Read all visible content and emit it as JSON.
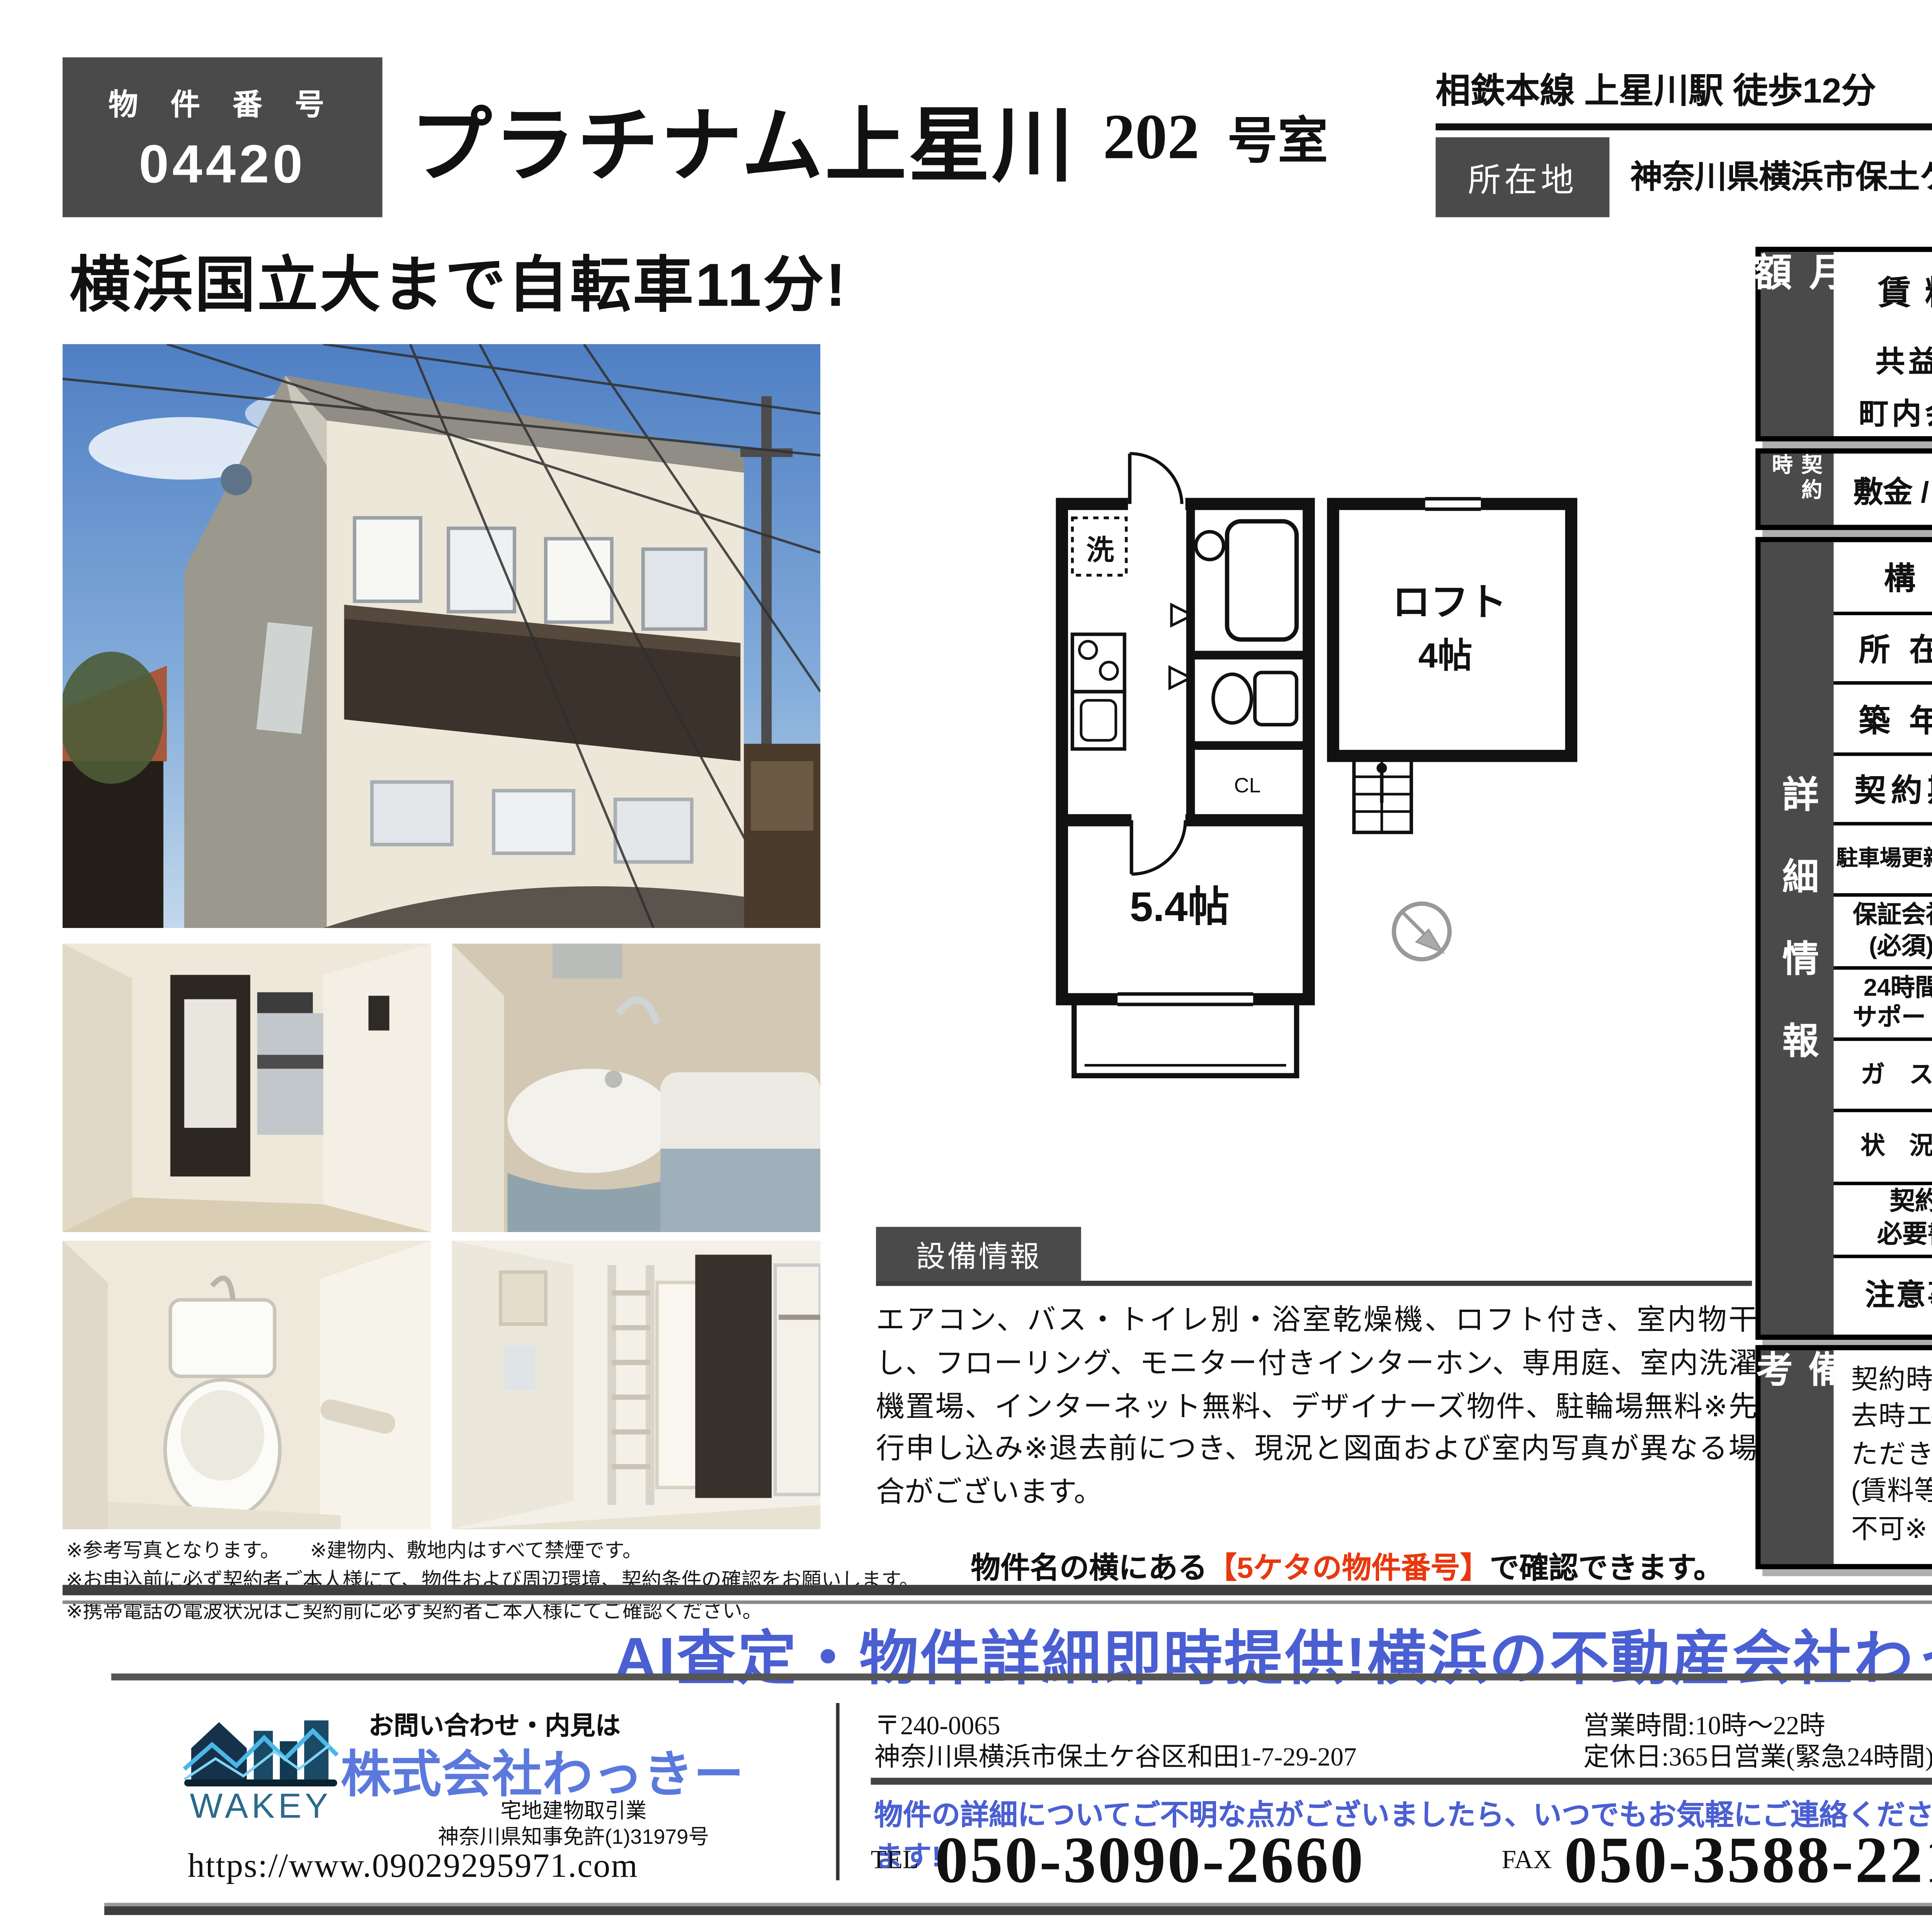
{
  "colors": {
    "accent_blue": "#4a5fd2",
    "brand_blue": "#5b79dd",
    "highlight_red": "#e8380f",
    "dark_gray": "#4a4a4a",
    "consult_bg": "#cfe3ea"
  },
  "header": {
    "property_number_label": "物 件 番 号",
    "property_number": "04420",
    "title": "プラチナム上星川",
    "room_number": "202",
    "room_suffix": "号室",
    "station": "相鉄本線 上星川駅 徒歩12分",
    "location_label": "所在地",
    "address": "神奈川県横浜市保土ケ谷区坂本町326-17",
    "layout": "1K",
    "area_label": "専有面積",
    "area_value": "16.66㎡"
  },
  "catchphrase": "横浜国立大まで自転車11分!",
  "photo_notes": [
    "※参考写真となります。　　※建物内、敷地内はすべて禁煙です。",
    "※お申込前に必ず契約者ご本人様にて、物件および周辺環境、契約条件の確認をお願いします。",
    "※携帯電話の電波状況はご契約前に必ず契約者ご本人様にてご確認ください。"
  ],
  "floorplan": {
    "laundry": "洗",
    "closet": "CL",
    "room_size": "5.4帖",
    "loft_label": "ロフト",
    "loft_size": "4帖"
  },
  "rent_table": {
    "sidebar": "月額",
    "rent_label": "賃料",
    "rent_value": "49,000",
    "rent_unit": "円",
    "fee_label": "共益費",
    "fee_value": "3,000",
    "fee_unit": "円",
    "town_label": "町内会費",
    "town_value": "300",
    "town_unit": "円"
  },
  "contract_table": {
    "sidebar": "契約時",
    "deposit_label": "敷金 / 礼金",
    "deposit_value": "0円 / 0円"
  },
  "detail_table": {
    "sidebar": "詳細情報",
    "rows2": [
      {
        "label": "構 造",
        "value": "木造"
      },
      {
        "label": "所 在 階",
        "value": "2階/2階建て"
      },
      {
        "label": "築 年 月",
        "value": "2007/08　築18年"
      },
      {
        "label": "契約期間",
        "value": "普通建物賃貸借契約　期間:2年"
      }
    ],
    "rows4": [
      {
        "l1": "駐車場更新料",
        "v1": "新賃料1ヶ月",
        "l2": "解約予告",
        "v2": "1ヶ月前まで"
      },
      {
        "l1": "保証会社\n(必須)",
        "v1": "賃料等の50%〜",
        "l2": "住宅保険\n(必須)",
        "v2": "18,000円 / 2年"
      },
      {
        "l1": "24時間\nサポート",
        "v1": "16,500円 / 2年",
        "l2": "鍵交換代",
        "v2": "8,800 円"
      },
      {
        "l1": "ガ ス",
        "v1": "プロパンガス",
        "l2": "電 気",
        "v2": "東京電力"
      },
      {
        "l1": "状 況",
        "v1": "2026年3月27日退去予定",
        "l2": "入居可能日",
        "v2": "相談"
      }
    ],
    "docs_label": "契約時\n必要書類",
    "docs_lines": [
      "申込時:身分証明書(顔写真付き)写し",
      "契約時:住民票",
      "　　　(本籍記載・マイナンバー未記載・3ヶ月以内取得の原本)"
    ],
    "notes_label": "注意事項",
    "notes_lines": [
      "※プロパンガスはご契約頂く際、別途保証金が掛かります。",
      "※ご入居後周辺環境等に変化が生じる場合がございます。",
      "※図面と現況が異なる場合は、現況優先とさせていただきます。"
    ]
  },
  "remarks": {
    "sidebar": "備考",
    "text": "契約時に退去時ハウスクリーニング費用33,000円(税込)、退去時エアコンクリーニング費用11,000円(税込)をお支払いいただきます。※1年未満の解約の場合、短期解約違約金あり(賃料等総額の1か月相当)※楽器・喫煙・事務所利用・民泊等不可※くらしーど24は更新必須"
  },
  "equipment": {
    "label": "設備情報",
    "text": "エアコン、バス・トイレ別・浴室乾燥機、ロフト付き、室内物干し、フローリング、モニター付きインターホン、専用庭、室内洗濯機置場、インターネット無料、デザイナーズ物件、駐輪場無料※先行申し込み※退去前につき、現況と図面および室内写真が異なる場合がございます。"
  },
  "number_note": {
    "prefix": "物件名の横にある",
    "highlight": "【5ケタの物件番号】",
    "suffix": "で確認できます。"
  },
  "banner": "AI査定・物件詳細即時提供!横浜の不動産会社わっきー",
  "footer": {
    "inquiry": "お問い合わせ・内見は",
    "company": "株式会社わっきー",
    "logo_text": "WAKEY",
    "business": "宅地建物取引業",
    "license": "神奈川県知事免許(1)31979号",
    "url": "https://www.09029295971.com",
    "postal": "〒240-0065",
    "address": "神奈川県横浜市保土ケ谷区和田1-7-29-207",
    "hours": "営業時間:10時〜22時",
    "holiday": "定休日:365日営業(緊急24時間)",
    "notice": "物件の詳細についてご不明な点がございましたら、いつでもお気軽にご連絡ください!即応します!",
    "tel_label": "TEL",
    "tel": "050-3090-2660",
    "fax_label": "FAX",
    "fax": "050-3588-2213",
    "consult": "お気軽に\n御相談\nください!",
    "email": "info@09029295971.com"
  }
}
